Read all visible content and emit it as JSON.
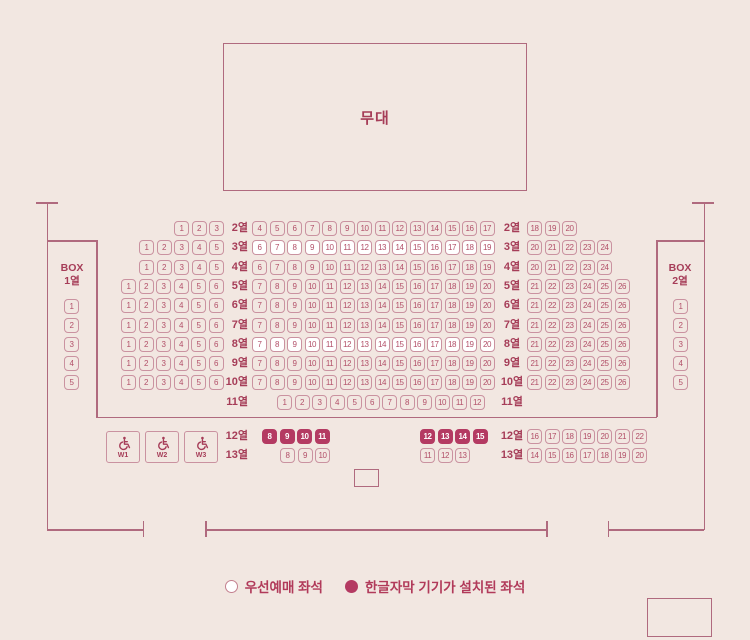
{
  "colors": {
    "bg": "#f2e7e1",
    "line": "#b06a7e",
    "seat_border": "#ca92a0",
    "seat_text": "#b24f68",
    "seat_white": "#ffffff",
    "seat_dark": "#b43a62",
    "seat_dark_text": "#ffffff",
    "label_color": "#a63d58",
    "legend_text": "#b13a5a"
  },
  "stage": {
    "label": "무대"
  },
  "legend": {
    "priority_label": "우선예매 좌석",
    "subtitle_label": "한글자막 기기가 설치된 좌석"
  },
  "seatmap": {
    "box_left": {
      "line1": "BOX",
      "line2": "1열",
      "seats": [
        1,
        2,
        3,
        4,
        5
      ]
    },
    "box_right": {
      "line1": "BOX",
      "line2": "2열",
      "seats": [
        1,
        2,
        3,
        4,
        5
      ]
    },
    "wheelchair_seats": [
      "W1",
      "W2",
      "W3"
    ],
    "rows": [
      {
        "num": 2,
        "label": "2열",
        "y": 221,
        "groups": [
          {
            "x": 174,
            "variant": "default",
            "seats": [
              1,
              2,
              3
            ]
          },
          {
            "x": 252,
            "variant": "default",
            "seats": [
              4,
              5,
              6,
              7,
              8,
              9,
              10,
              11,
              12,
              13,
              14,
              15,
              16,
              17
            ]
          },
          {
            "x": 527,
            "variant": "default",
            "seats": [
              18,
              19,
              20
            ]
          }
        ]
      },
      {
        "num": 3,
        "label": "3열",
        "y": 240,
        "groups": [
          {
            "x": 139,
            "variant": "default",
            "seats": [
              1,
              2,
              3,
              4,
              5
            ]
          },
          {
            "x": 252,
            "variant": "white",
            "seats": [
              6,
              7,
              8,
              9,
              10,
              11,
              12,
              13,
              14,
              15,
              16,
              17,
              18,
              19
            ]
          },
          {
            "x": 527,
            "variant": "default",
            "seats": [
              20,
              21,
              22,
              23,
              24
            ]
          }
        ]
      },
      {
        "num": 4,
        "label": "4열",
        "y": 260,
        "groups": [
          {
            "x": 139,
            "variant": "default",
            "seats": [
              1,
              2,
              3,
              4,
              5
            ]
          },
          {
            "x": 252,
            "variant": "default",
            "seats": [
              6,
              7,
              8,
              9,
              10,
              11,
              12,
              13,
              14,
              15,
              16,
              17,
              18,
              19
            ]
          },
          {
            "x": 527,
            "variant": "default",
            "seats": [
              20,
              21,
              22,
              23,
              24
            ]
          }
        ]
      },
      {
        "num": 5,
        "label": "5열",
        "y": 279,
        "groups": [
          {
            "x": 121,
            "variant": "default",
            "seats": [
              1,
              2,
              3,
              4,
              5,
              6
            ]
          },
          {
            "x": 252,
            "variant": "default",
            "seats": [
              7,
              8,
              9,
              10,
              11,
              12,
              13,
              14,
              15,
              16,
              17,
              18,
              19,
              20
            ]
          },
          {
            "x": 527,
            "variant": "default",
            "seats": [
              21,
              22,
              23,
              24,
              25,
              26
            ]
          }
        ]
      },
      {
        "num": 6,
        "label": "6열",
        "y": 298,
        "groups": [
          {
            "x": 121,
            "variant": "default",
            "seats": [
              1,
              2,
              3,
              4,
              5,
              6
            ]
          },
          {
            "x": 252,
            "variant": "default",
            "seats": [
              7,
              8,
              9,
              10,
              11,
              12,
              13,
              14,
              15,
              16,
              17,
              18,
              19,
              20
            ]
          },
          {
            "x": 527,
            "variant": "default",
            "seats": [
              21,
              22,
              23,
              24,
              25,
              26
            ]
          }
        ]
      },
      {
        "num": 7,
        "label": "7열",
        "y": 318,
        "groups": [
          {
            "x": 121,
            "variant": "default",
            "seats": [
              1,
              2,
              3,
              4,
              5,
              6
            ]
          },
          {
            "x": 252,
            "variant": "default",
            "seats": [
              7,
              8,
              9,
              10,
              11,
              12,
              13,
              14,
              15,
              16,
              17,
              18,
              19,
              20
            ]
          },
          {
            "x": 527,
            "variant": "default",
            "seats": [
              21,
              22,
              23,
              24,
              25,
              26
            ]
          }
        ]
      },
      {
        "num": 8,
        "label": "8열",
        "y": 337,
        "groups": [
          {
            "x": 121,
            "variant": "default",
            "seats": [
              1,
              2,
              3,
              4,
              5,
              6
            ]
          },
          {
            "x": 252,
            "variant": "white",
            "seats": [
              7,
              8,
              9,
              10,
              11,
              12,
              13,
              14,
              15,
              16,
              17,
              18,
              19,
              20
            ]
          },
          {
            "x": 527,
            "variant": "default",
            "seats": [
              21,
              22,
              23,
              24,
              25,
              26
            ]
          }
        ]
      },
      {
        "num": 9,
        "label": "9열",
        "y": 356,
        "groups": [
          {
            "x": 121,
            "variant": "default",
            "seats": [
              1,
              2,
              3,
              4,
              5,
              6
            ]
          },
          {
            "x": 252,
            "variant": "default",
            "seats": [
              7,
              8,
              9,
              10,
              11,
              12,
              13,
              14,
              15,
              16,
              17,
              18,
              19,
              20
            ]
          },
          {
            "x": 527,
            "variant": "default",
            "seats": [
              21,
              22,
              23,
              24,
              25,
              26
            ]
          }
        ]
      },
      {
        "num": 10,
        "label": "10열",
        "y": 375,
        "groups": [
          {
            "x": 121,
            "variant": "default",
            "seats": [
              1,
              2,
              3,
              4,
              5,
              6
            ]
          },
          {
            "x": 252,
            "variant": "default",
            "seats": [
              7,
              8,
              9,
              10,
              11,
              12,
              13,
              14,
              15,
              16,
              17,
              18,
              19,
              20
            ]
          },
          {
            "x": 527,
            "variant": "default",
            "seats": [
              21,
              22,
              23,
              24,
              25,
              26
            ]
          }
        ]
      },
      {
        "num": 11,
        "label": "11열",
        "y": 395,
        "groups": [
          {
            "x": 277,
            "variant": "default",
            "seats": [
              1,
              2,
              3,
              4,
              5,
              6,
              7,
              8,
              9,
              10,
              11,
              12
            ]
          }
        ]
      },
      {
        "num": 12,
        "label": "12열",
        "y": 429,
        "groups": [
          {
            "x": 262,
            "variant": "dark",
            "seats": [
              8,
              9,
              10,
              11
            ]
          },
          {
            "x": 420,
            "variant": "dark",
            "seats": [
              12,
              13,
              14,
              15
            ]
          },
          {
            "x": 527,
            "variant": "default",
            "seats": [
              16,
              17,
              18,
              19,
              20,
              21,
              22
            ]
          }
        ]
      },
      {
        "num": 13,
        "label": "13열",
        "y": 448,
        "groups": [
          {
            "x": 280,
            "variant": "default",
            "seats": [
              8,
              9,
              10
            ]
          },
          {
            "x": 420,
            "variant": "default",
            "seats": [
              11,
              12,
              13
            ]
          },
          {
            "x": 527,
            "variant": "default",
            "seats": [
              14,
              15,
              16,
              17,
              18,
              19,
              20
            ]
          }
        ]
      }
    ]
  }
}
